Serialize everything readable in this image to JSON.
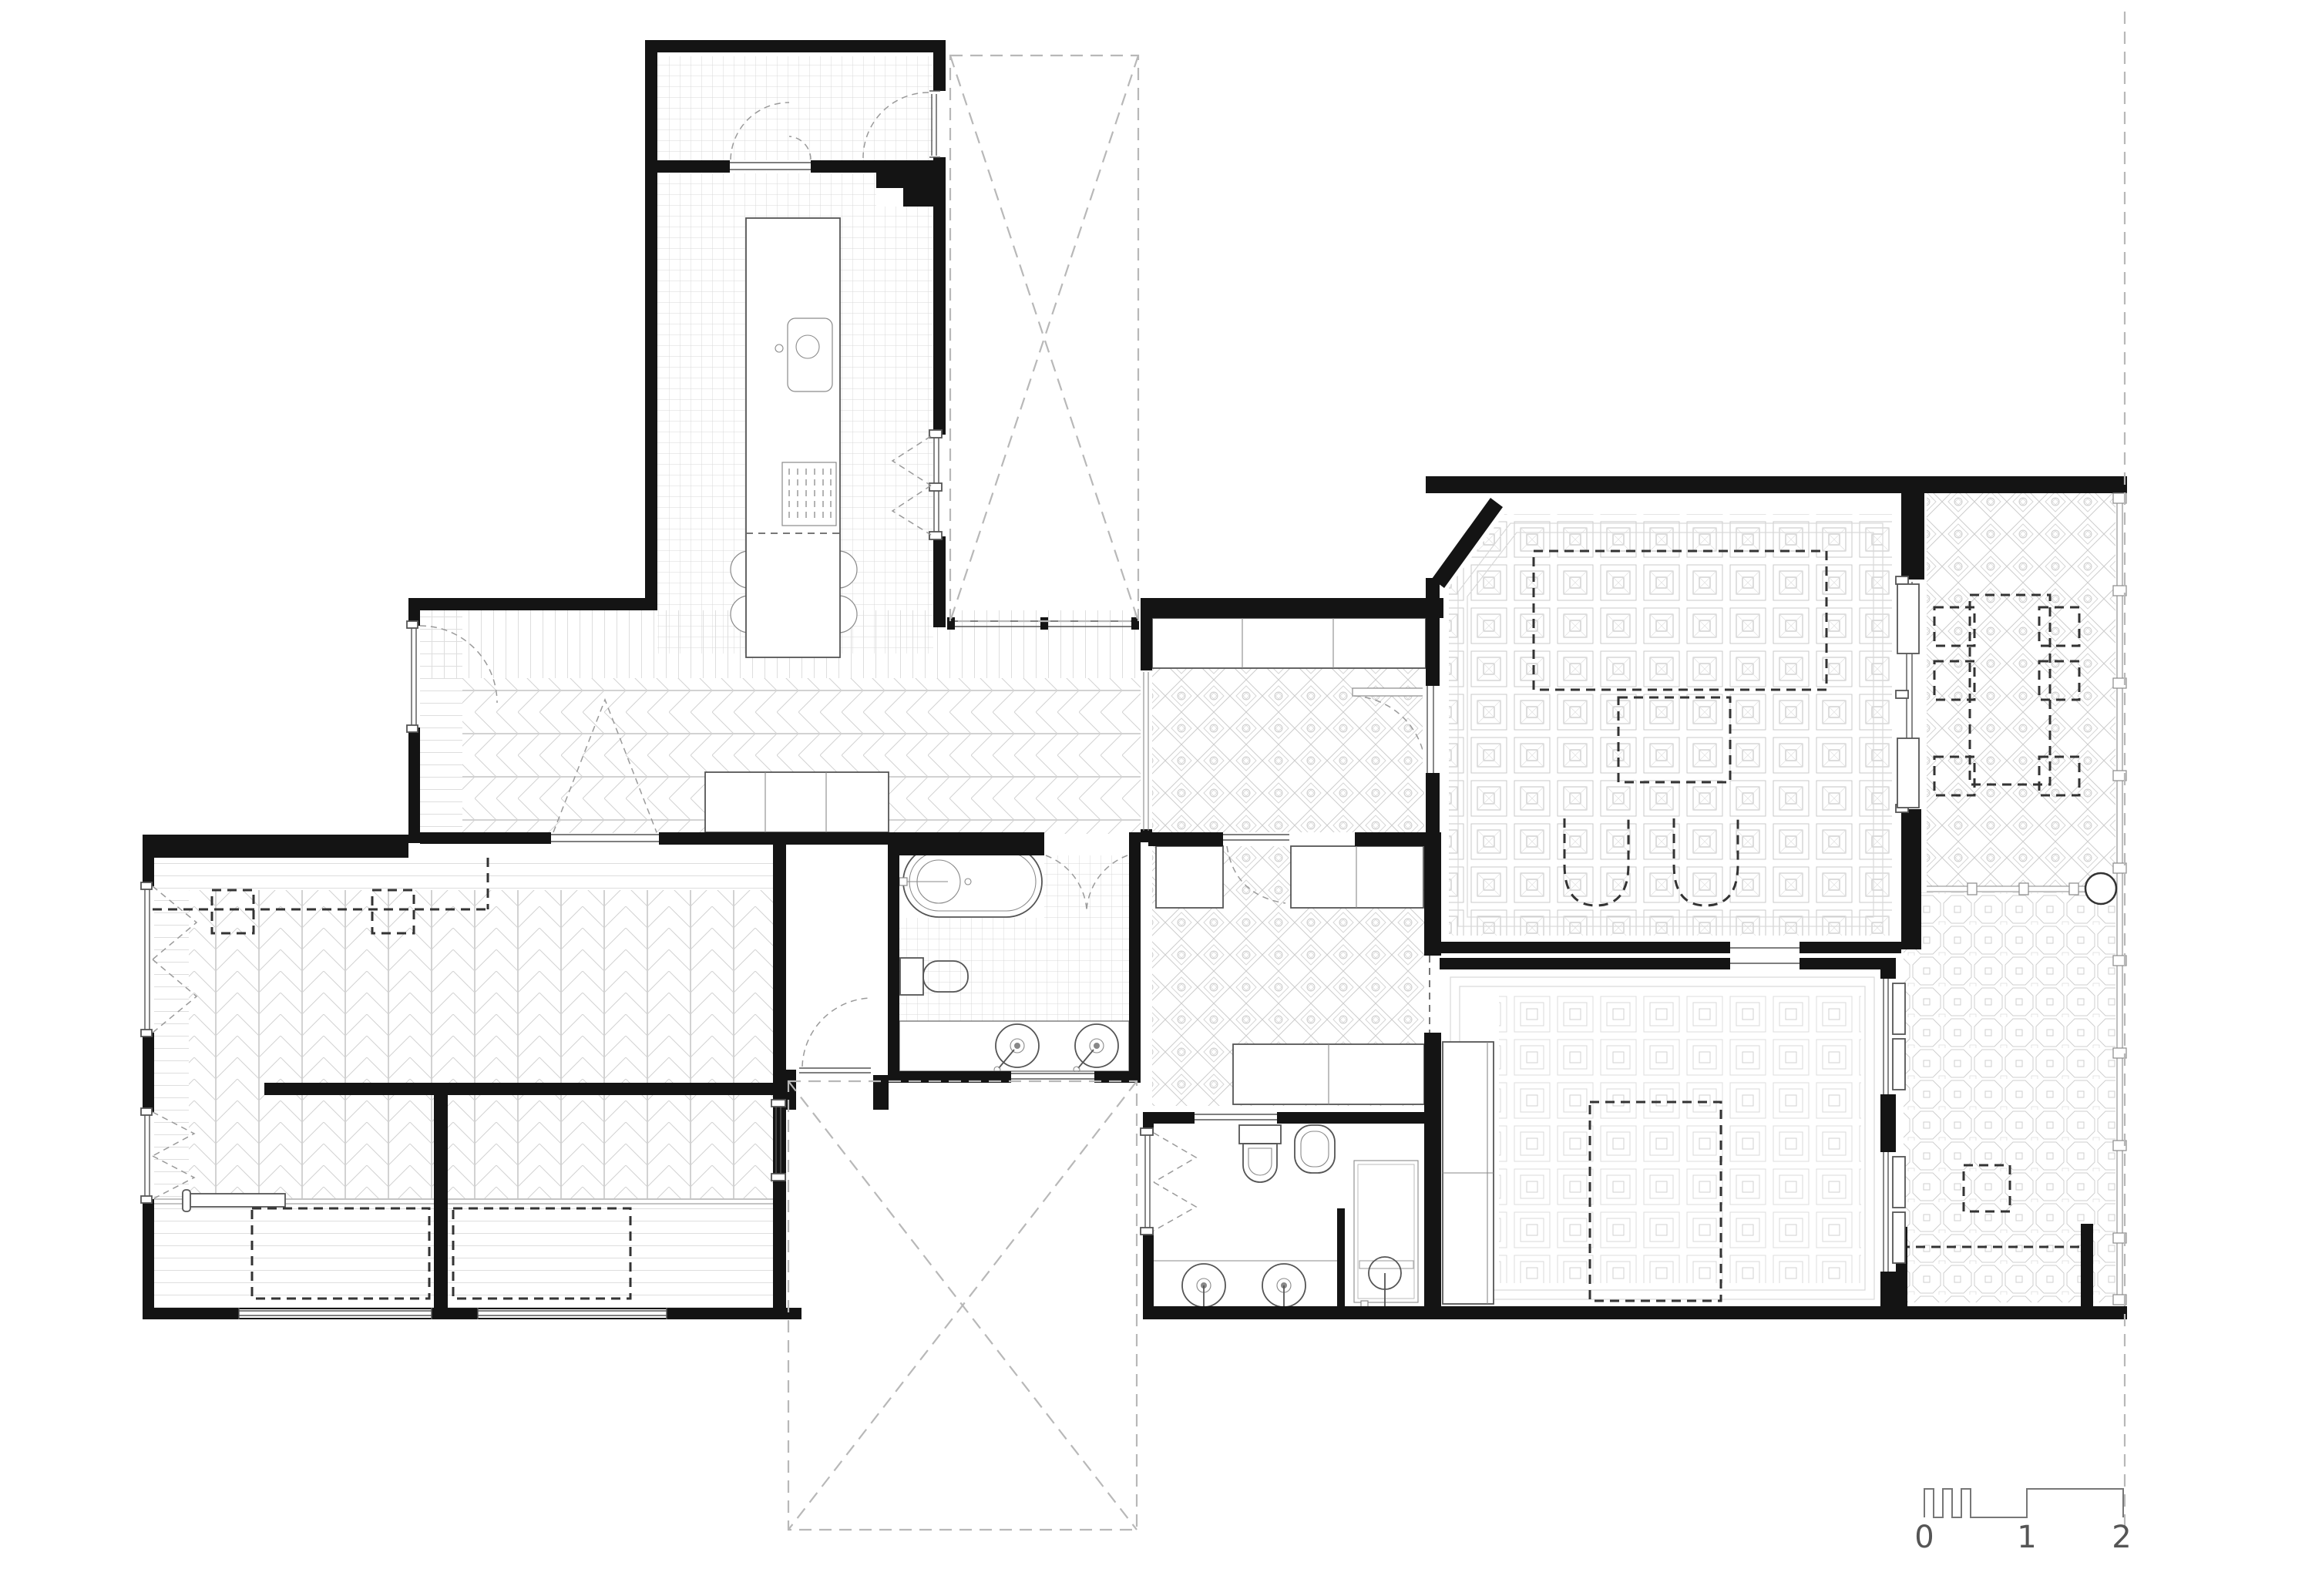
{
  "drawing": {
    "kind": "architectural floor plan",
    "style": "black and white line drawing, top view"
  },
  "colors": {
    "wall": "#141414",
    "line": "#555555",
    "pattern": "#cfcfcf",
    "dashed_furniture": "#333333",
    "dashed_site": "#b8b8b8",
    "text": "#555555",
    "background": "#ffffff"
  },
  "scale_bar": {
    "labels": [
      "0",
      "1",
      "2"
    ]
  }
}
